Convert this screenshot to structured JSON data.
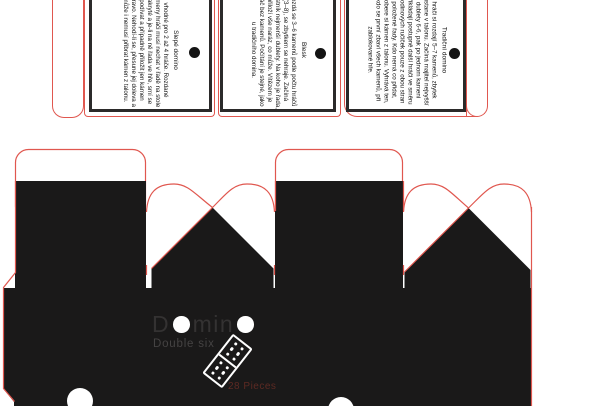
{
  "document": {
    "kind": "domino box packaging dieline with three rule tags",
    "colors": {
      "cut_line": "#e0574f",
      "print_black": "#1a1919",
      "panel_border": "#2b2a2a",
      "brand_text": "#343232",
      "subtitle_text": "#454343",
      "pieces_text": "#5d2a23"
    }
  },
  "tags": [
    {
      "title": "Slepé domino",
      "body": "vhodné pro 2 až 4 hráče. Rozdané kameny hráči musí nechat v řadě na stole zakryté a je-li na ně řada ve hře, smí se podívat a případně přiložit jen kámen vpravo. Nehodí-li se, přesune jej doleva a může i nemusí přibrat kámen z talonu."
    },
    {
      "title": "Blesk",
      "body": "Rozdá se 3–6 kamenů podle počtu hráčů (3–8), se zbytkem se nehraje. Začíná vlastník nejmenší dublety. Na koho je řada, přiloží vše naráz, co může. Vítězem je hráč bez kamenů. Počítání je stejné, jako u tradičního domina."
    },
    {
      "title": "Tradiční domino",
      "body": "hráči si rozdají 5–7 kamenů, zbytek zůstane v talonu. Začíná majitel nejvyšší dublety 6-6, pak po jednom kameni přikládají postupně další hráči ve směru hodinových ručiček pouze z obou stran položené řady. Kdo nemá co přidat, dobere si kámen z talonu. Vyhrává ten, kdo se první zbaví všech kamenů, při zablokované hře."
    }
  ],
  "box": {
    "brand_d": "D",
    "brand_min": "min",
    "subtitle": "Double six",
    "pieces": "28 Pieces"
  }
}
